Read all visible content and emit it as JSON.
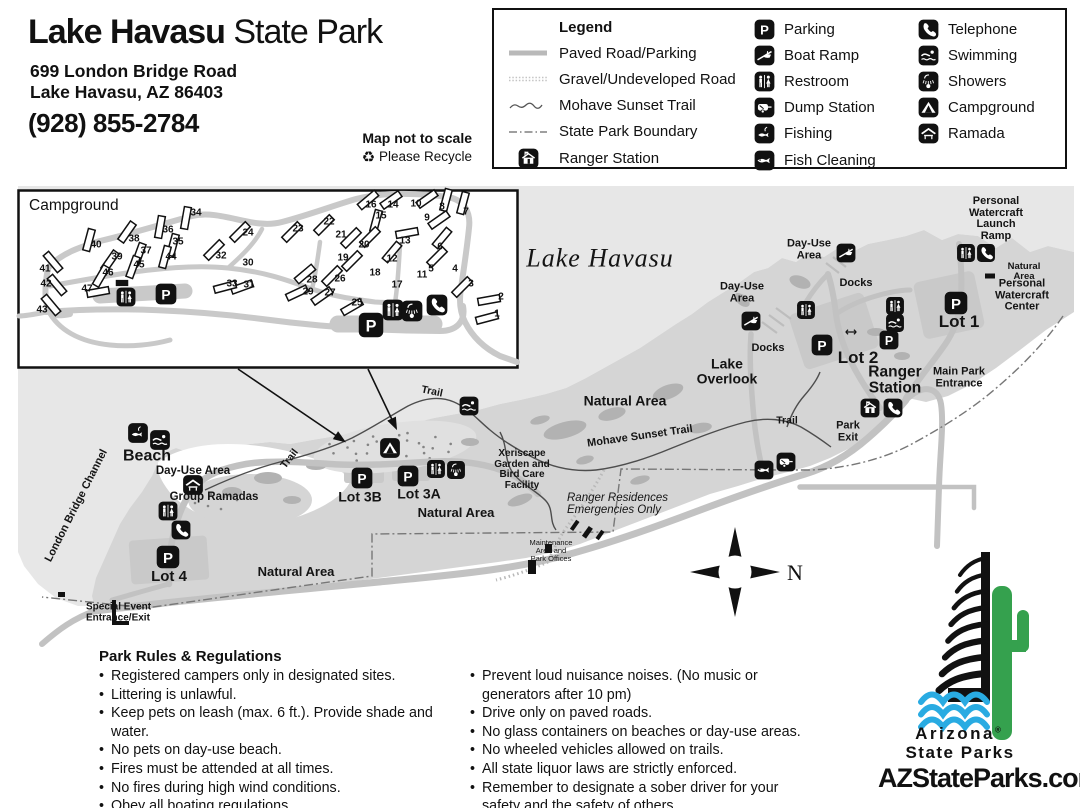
{
  "colors": {
    "water": "#e7e7e7",
    "land": "#d5d5d5",
    "road": "#c2c2c2",
    "inset_road": "#c9c9c9",
    "vegetation": "#b2b2b2",
    "ink": "#111111",
    "cactus_green": "#35a14e",
    "wave_blue": "#29abe2"
  },
  "header": {
    "title_bold": "Lake Havasu",
    "title_light": "State Park",
    "address1": "699 London Bridge Road",
    "address2": "Lake Havasu, AZ 86403",
    "phone": "(928) 855-2784"
  },
  "map_note": {
    "line1": "Map not to scale",
    "recycle_glyph": "♻",
    "line2": "Please Recycle"
  },
  "legend": {
    "title": "Legend",
    "line_items": [
      {
        "sample": "paved",
        "label": "Paved Road/Parking"
      },
      {
        "sample": "gravel",
        "label": "Gravel/Undeveloped Road"
      },
      {
        "sample": "trail",
        "label": "Mohave Sunset Trail"
      },
      {
        "sample": "boundary",
        "label": "State Park Boundary"
      },
      {
        "sample": "icon:ranger-station",
        "label": "Ranger Station"
      }
    ],
    "col2": [
      {
        "icon": "parking",
        "label": "Parking"
      },
      {
        "icon": "boat-ramp",
        "label": "Boat Ramp"
      },
      {
        "icon": "restroom",
        "label": "Restroom"
      },
      {
        "icon": "dump-station",
        "label": "Dump Station"
      },
      {
        "icon": "fishing",
        "label": "Fishing"
      },
      {
        "icon": "fish-cleaning",
        "label": "Fish Cleaning"
      }
    ],
    "col3": [
      {
        "icon": "telephone",
        "label": "Telephone"
      },
      {
        "icon": "swimming",
        "label": "Swimming"
      },
      {
        "icon": "showers",
        "label": "Showers"
      },
      {
        "icon": "campground",
        "label": "Campground"
      },
      {
        "icon": "ramada",
        "label": "Ramada"
      }
    ]
  },
  "inset": {
    "title": "Campground",
    "sites": [
      [
        1,
        487,
        318,
        75,
        497,
        313
      ],
      [
        2,
        489,
        300,
        80,
        501,
        296
      ],
      [
        3,
        462,
        287,
        45,
        471,
        283
      ],
      [
        4,
        null,
        null,
        null,
        455,
        268
      ],
      [
        5,
        437,
        257,
        45,
        431,
        268
      ],
      [
        6,
        442,
        238,
        40,
        440,
        246
      ],
      [
        7,
        463,
        203,
        15,
        466,
        211
      ],
      [
        8,
        446,
        200,
        15,
        442,
        206
      ],
      [
        9,
        439,
        220,
        55,
        427,
        217
      ],
      [
        10,
        427,
        199,
        55,
        416,
        203
      ],
      [
        11,
        null,
        null,
        null,
        422,
        274
      ],
      [
        12,
        392,
        252,
        40,
        392,
        258
      ],
      [
        13,
        407,
        233,
        80,
        405,
        240
      ],
      [
        14,
        391,
        200,
        55,
        393,
        204
      ],
      [
        15,
        376,
        221,
        15,
        381,
        215
      ],
      [
        16,
        368,
        200,
        50,
        371,
        204
      ],
      [
        17,
        null,
        null,
        null,
        397,
        284
      ],
      [
        18,
        null,
        null,
        null,
        375,
        272
      ],
      [
        19,
        352,
        261,
        45,
        343,
        257
      ],
      [
        20,
        370,
        237,
        45,
        364,
        244
      ],
      [
        21,
        351,
        238,
        45,
        341,
        234
      ],
      [
        22,
        324,
        225,
        45,
        329,
        221
      ],
      [
        23,
        292,
        232,
        45,
        298,
        228
      ],
      [
        24,
        240,
        232,
        45,
        248,
        232
      ],
      [
        25,
        352,
        307,
        60,
        357,
        302
      ],
      [
        26,
        332,
        276,
        45,
        340,
        278
      ],
      [
        27,
        322,
        296,
        55,
        330,
        292
      ],
      [
        28,
        305,
        274,
        50,
        312,
        279
      ],
      [
        29,
        297,
        293,
        65,
        308,
        291
      ],
      [
        30,
        null,
        null,
        null,
        248,
        262
      ],
      [
        31,
        242,
        287,
        70,
        249,
        284
      ],
      [
        32,
        214,
        250,
        45,
        221,
        255
      ],
      [
        33,
        225,
        287,
        75,
        232,
        283
      ],
      [
        34,
        186,
        218,
        10,
        196,
        212
      ],
      [
        35,
        173,
        245,
        15,
        178,
        241
      ],
      [
        36,
        160,
        227,
        10,
        168,
        229
      ],
      [
        37,
        139,
        254,
        20,
        146,
        250
      ],
      [
        38,
        127,
        232,
        35,
        134,
        238
      ],
      [
        39,
        110,
        261,
        35,
        117,
        256
      ],
      [
        40,
        89,
        240,
        15,
        96,
        244
      ],
      [
        41,
        53,
        262,
        -40,
        45,
        268
      ],
      [
        42,
        57,
        285,
        -40,
        46,
        283
      ],
      [
        43,
        51,
        305,
        -40,
        42,
        309
      ],
      [
        44,
        165,
        257,
        15,
        171,
        256
      ],
      [
        45,
        133,
        267,
        20,
        139,
        264
      ],
      [
        46,
        101,
        276,
        30,
        108,
        272
      ],
      [
        47,
        98,
        292,
        80,
        87,
        288
      ]
    ],
    "icons": [
      [
        "restroom",
        126,
        297,
        20
      ],
      [
        "parking",
        166,
        294,
        22
      ],
      [
        "building-bar",
        122,
        283,
        15
      ],
      [
        "parking",
        371,
        325,
        26
      ],
      [
        "restroom",
        393,
        310,
        22
      ],
      [
        "showers",
        412,
        311,
        22
      ],
      [
        "telephone",
        437,
        305,
        22
      ]
    ]
  },
  "map": {
    "compass_label": "N",
    "labels": [
      {
        "id": "lake-name",
        "t": "Lake Havasu",
        "x": 600,
        "y": 258,
        "s": 26,
        "b": false,
        "i": true,
        "f": true,
        "ls": 1
      },
      {
        "id": "day-use-area-ne",
        "t": "Day-Use\nArea",
        "x": 809,
        "y": 250,
        "s": 11
      },
      {
        "id": "docks-ne",
        "t": "Docks",
        "x": 856,
        "y": 284,
        "s": 11
      },
      {
        "id": "pwc-launch",
        "t": "Personal\nWatercraft\nLaunch\nRamp",
        "x": 996,
        "y": 219,
        "s": 11
      },
      {
        "id": "natural-area-ne",
        "t": "Natural Area",
        "x": 1024,
        "y": 272,
        "s": 9.5
      },
      {
        "id": "pwc-center",
        "t": "Personal\nWatercraft\nCenter",
        "x": 1022,
        "y": 296,
        "s": 11
      },
      {
        "id": "lot-1",
        "t": "Lot 1",
        "x": 959,
        "y": 322,
        "s": 17
      },
      {
        "id": "lot-2",
        "t": "Lot 2",
        "x": 858,
        "y": 358,
        "s": 17
      },
      {
        "id": "ranger-station-label",
        "t": "Ranger\nStation",
        "x": 895,
        "y": 381,
        "s": 15.5
      },
      {
        "id": "main-park-entrance",
        "t": "Main Park\nEntrance",
        "x": 959,
        "y": 378,
        "s": 11
      },
      {
        "id": "park-exit",
        "t": "Park\nExit",
        "x": 848,
        "y": 432,
        "s": 11
      },
      {
        "id": "day-use-area-mid",
        "t": "Day-Use\nArea",
        "x": 742,
        "y": 293,
        "s": 11
      },
      {
        "id": "docks-mid",
        "t": "Docks",
        "x": 768,
        "y": 349,
        "s": 11
      },
      {
        "id": "lake-overlook",
        "t": "Lake\nOverlook",
        "x": 727,
        "y": 371,
        "s": 14
      },
      {
        "id": "natural-area-n",
        "t": "Natural Area",
        "x": 625,
        "y": 401,
        "s": 14
      },
      {
        "id": "mohave-sunset-trail",
        "t": "Mohave Sunset Trail",
        "x": 640,
        "y": 437,
        "s": 11,
        "r": -8
      },
      {
        "id": "trail-ne",
        "t": "Trail",
        "x": 787,
        "y": 421,
        "s": 10.5
      },
      {
        "id": "trail-n",
        "t": "Trail",
        "x": 432,
        "y": 392,
        "s": 10.5,
        "r": 12
      },
      {
        "id": "trail-w",
        "t": "Trail",
        "x": 290,
        "y": 459,
        "s": 10.5,
        "r": -52
      },
      {
        "id": "xeriscape",
        "t": "Xeriscape\nGarden and\nBird Care\nFacility",
        "x": 522,
        "y": 470,
        "s": 10
      },
      {
        "id": "ranger-residences",
        "t": "Ranger Residences\nEmergencies Only",
        "x": 567,
        "y": 504,
        "s": 11.5,
        "b": false,
        "i": true,
        "a": "left"
      },
      {
        "id": "maintenance",
        "t": "Maintenance\nArea and\nPark Offices",
        "x": 551,
        "y": 551,
        "s": 7.5,
        "b": false
      },
      {
        "id": "beach",
        "t": "Beach",
        "x": 147,
        "y": 457,
        "s": 16
      },
      {
        "id": "day-use-area-w",
        "t": "Day-Use Area",
        "x": 193,
        "y": 471,
        "s": 11.5
      },
      {
        "id": "group-ramadas",
        "t": "Group Ramadas",
        "x": 214,
        "y": 497,
        "s": 11.5
      },
      {
        "id": "london-bridge-channel",
        "t": "London Bridge Channel",
        "x": 77,
        "y": 506,
        "s": 11,
        "r": -63
      },
      {
        "id": "lot-3b",
        "t": "Lot 3B",
        "x": 360,
        "y": 497,
        "s": 14
      },
      {
        "id": "lot-3a",
        "t": "Lot 3A",
        "x": 419,
        "y": 494,
        "s": 14
      },
      {
        "id": "natural-area-c",
        "t": "Natural Area",
        "x": 456,
        "y": 513,
        "s": 13
      },
      {
        "id": "natural-area-sw",
        "t": "Natural Area",
        "x": 296,
        "y": 572,
        "s": 13
      },
      {
        "id": "lot-4",
        "t": "Lot 4",
        "x": 169,
        "y": 577,
        "s": 15
      },
      {
        "id": "special-event",
        "t": "Special Event\nEntrance/Exit",
        "x": 86,
        "y": 613,
        "s": 10,
        "a": "left"
      }
    ],
    "icons": [
      [
        "boat-ramp",
        846,
        253,
        20
      ],
      [
        "restroom",
        966,
        253,
        19
      ],
      [
        "telephone",
        986,
        253,
        19
      ],
      [
        "building-bar",
        990,
        276,
        12
      ],
      [
        "restroom",
        806,
        310,
        19
      ],
      [
        "restroom",
        895,
        306,
        19
      ],
      [
        "swimming",
        895,
        323,
        19
      ],
      [
        "parking",
        822,
        345,
        22
      ],
      [
        "parking",
        889,
        340,
        20
      ],
      [
        "arrow-lr",
        851,
        332,
        14
      ],
      [
        "parking",
        956,
        303,
        24
      ],
      [
        "ranger-station",
        870,
        408,
        20
      ],
      [
        "telephone",
        893,
        408,
        20
      ],
      [
        "boat-ramp",
        751,
        321,
        20
      ],
      [
        "swimming",
        469,
        406,
        20
      ],
      [
        "campground",
        390,
        448,
        21
      ],
      [
        "parking",
        362,
        478,
        22
      ],
      [
        "parking",
        408,
        476,
        22
      ],
      [
        "restroom",
        436,
        469,
        19
      ],
      [
        "showers",
        456,
        470,
        19
      ],
      [
        "fish-cleaning",
        764,
        470,
        20
      ],
      [
        "dump-station",
        786,
        462,
        20
      ],
      [
        "fishing",
        138,
        433,
        21
      ],
      [
        "swimming",
        160,
        440,
        21
      ],
      [
        "ramada",
        193,
        485,
        21
      ],
      [
        "restroom",
        168,
        511,
        20
      ],
      [
        "telephone",
        181,
        530,
        20
      ],
      [
        "parking",
        168,
        557,
        24
      ]
    ]
  },
  "rules": {
    "title": "Park Rules & Regulations",
    "col1": [
      "Registered campers only in designated sites.",
      "Littering is unlawful.",
      "Keep pets on leash (max. 6 ft.). Provide shade and water.",
      "No pets on day-use beach.",
      "Fires must be attended at all times.",
      "No fires during high wind conditions.",
      "Obey all boating regulations.",
      "Quiet hours are from 10 pm to 6 am."
    ],
    "col2": [
      "Prevent loud nuisance noises. (No music or generators after 10 pm)",
      "Drive only on paved roads.",
      "No glass containers on beaches or day-use areas.",
      "No wheeled vehicles allowed on trails.",
      "All state liquor laws are strictly enforced.",
      "Remember to designate a sober driver for your safety and the safety of others."
    ]
  },
  "logo": {
    "line1": "Arizona",
    "registered": "®",
    "line2": "State Parks",
    "website": "AZStateParks.com"
  }
}
